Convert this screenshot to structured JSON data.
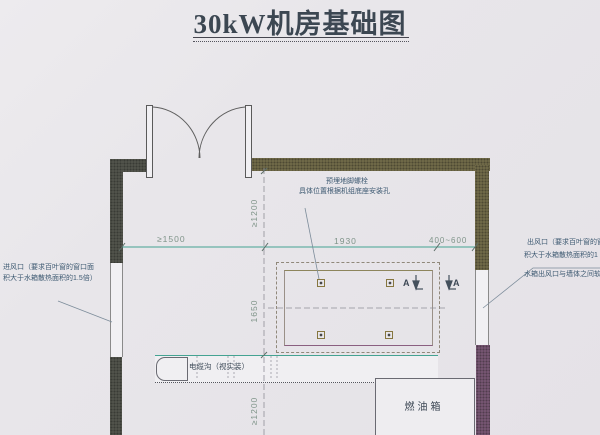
{
  "title": {
    "text": "30kW机房基础图"
  },
  "notes": {
    "anchor_bolt": {
      "line1": "预埋地脚螺栓",
      "line2": "具体位置根据机组底座安装孔"
    },
    "air_inlet": {
      "line1": "进风口（要求百叶窗的窗口面",
      "line2": "积大于水箱散热面积的1.5倍）"
    },
    "air_outlet": {
      "line1": "出风口（要求百叶窗的窗",
      "line2": "积大于水箱散热面积的1",
      "line3": "水箱出风口与墙体之间软"
    },
    "cable_trench": {
      "label": "电缆沟（视实装）"
    },
    "fuel_tank": {
      "label": "燃油箱"
    },
    "section": {
      "letter_left": "A",
      "letter_right": "A"
    }
  },
  "dimensions": {
    "h_left": "≥1500",
    "h_mid": "1930",
    "h_right": "400~600",
    "v_top": "≥1200",
    "v_mid": "1650",
    "v_bottom": "≥1200"
  },
  "colors": {
    "wall_charcoal": "#56584f",
    "wall_olive": "#76704c",
    "wall_purple": "#7d5a78",
    "dim_line_teal": "#44a392",
    "note_text": "#3e5a72",
    "dim_text": "#7f9489",
    "title_text": "#3c4752",
    "paper": "#e8e6ea"
  }
}
